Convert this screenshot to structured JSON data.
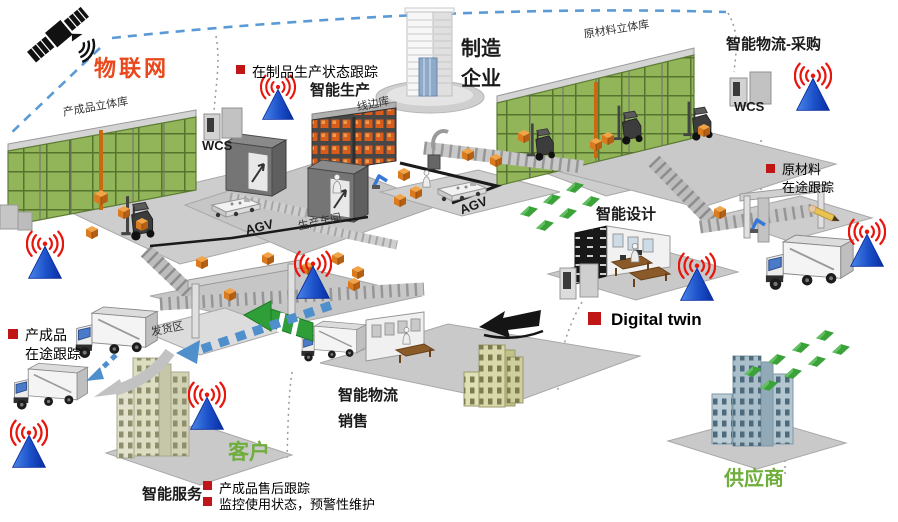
{
  "colors": {
    "iot_label": "#e8481c",
    "partner_label_green": "#6fae3c",
    "bullet_red": "#c11616",
    "antenna_blue": "#1b50c8",
    "signal_red": "#e8150d",
    "rack_green": "#93b55a",
    "cargo_orange": "#e2822a",
    "flow_green": "#2f9e38",
    "flow_blue_dashed": "#4f8fcc",
    "platform_gray": "#c9c9c9"
  },
  "labels": {
    "iot": "物联网",
    "finished_goods_warehouse": "产成品立体库",
    "wcs_left": "WCS",
    "wip_tracking": "在制品生产状态跟踪",
    "smart_production": "智能生产",
    "line_side_warehouse": "线边库",
    "manufacturer": {
      "line1": "制造",
      "line2": "企业"
    },
    "raw_material_warehouse": "原材料立体库",
    "smart_logistics_procurement": "智能物流-采购",
    "wcs_right": "WCS",
    "raw_material_tracking": {
      "line1": "原材料",
      "line2": "在途跟踪"
    },
    "agv_left": "AGV",
    "agv_center": "AGV",
    "production_workshop": "生产车间",
    "smart_design": "智能设计",
    "digital_twin": "Digital twin",
    "shipping_area": "发货区",
    "finished_goods_tracking": {
      "line1": "产成品",
      "line2": "在途跟踪"
    },
    "smart_logistics_sales": {
      "line1": "智能物流",
      "line2": "销售"
    },
    "customer": "客户",
    "smart_service": "智能服务",
    "aftersales_tracking": "产成品售后跟踪",
    "monitoring_maintenance": "监控使用状态，预警性维护",
    "supplier": "供应商"
  },
  "icons": [
    "satellite-icon",
    "wireless-antenna-icon",
    "truck-icon",
    "forklift-icon",
    "agv-icon",
    "cargo-box-icon",
    "flow-chevron-icon",
    "person-icon",
    "red-square-bullet-icon",
    "robot-arm-icon",
    "hand-pen-icon"
  ]
}
